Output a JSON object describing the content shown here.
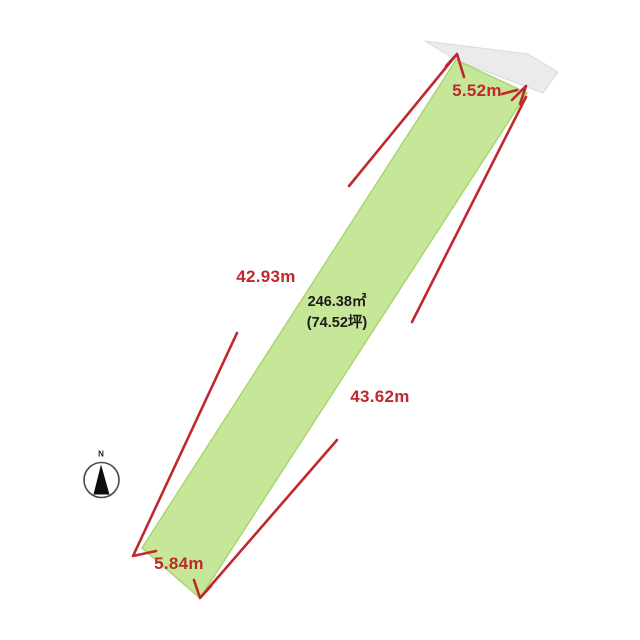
{
  "diagram": {
    "type": "land-plot-survey",
    "area_label": {
      "line1": "246.38㎡",
      "line2": "(74.52坪)"
    },
    "dimensions": {
      "top_edge": "5.52m",
      "left_edge": "42.93m",
      "right_edge": "43.62m",
      "bottom_edge": "5.84m"
    },
    "compass": {
      "north_label": "N"
    },
    "colors": {
      "plot_fill": "#c6e798",
      "plot_stroke": "#a9d573",
      "neighbor_fill": "#ebebeb",
      "neighbor_stroke": "#d9d9d9",
      "dimension_red": "#c0282e",
      "area_text": "#1a1a1a",
      "background": "#ffffff"
    }
  }
}
